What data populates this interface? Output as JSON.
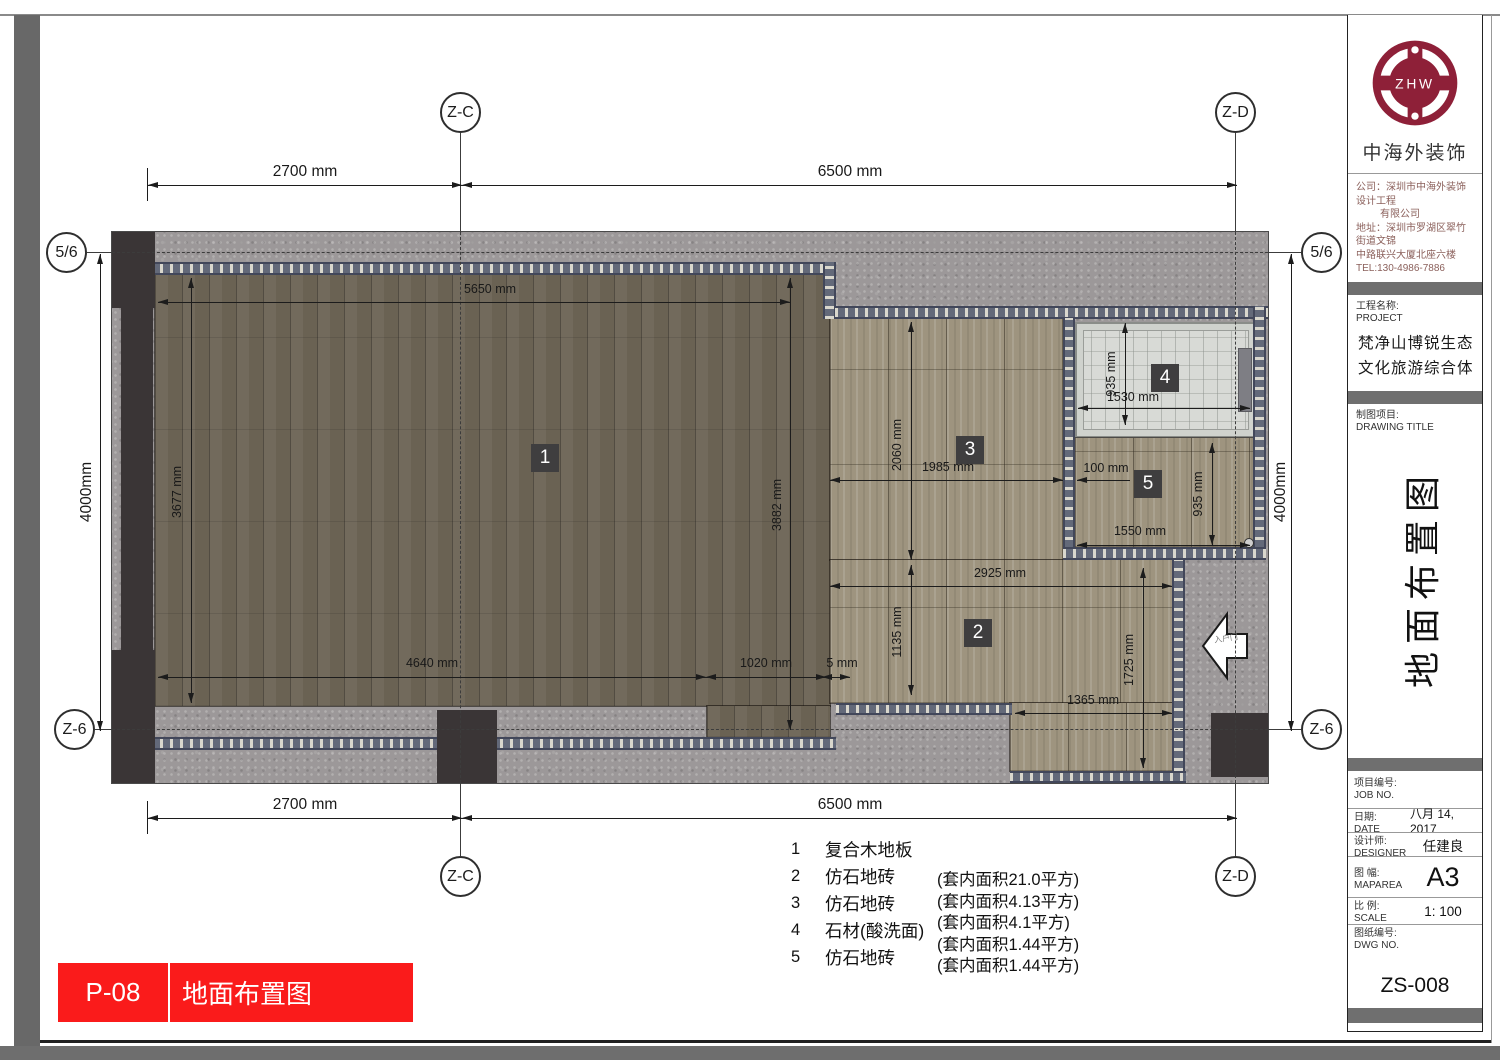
{
  "markers": {
    "zc": "Z-C",
    "zd": "Z-D",
    "axis56": "5/6",
    "z6": "Z-6"
  },
  "plan": {
    "entry_door": "入户门",
    "region_labels": {
      "r1": "1",
      "r2": "2",
      "r3": "3",
      "r4": "4",
      "r5": "5"
    },
    "dims": {
      "top_left": "2700 mm",
      "top_right": "6500 mm",
      "bottom_left": "2700 mm",
      "bottom_right": "6500 mm",
      "side_left": "4000mm",
      "side_right": "4000mm",
      "r1_top": "5650 mm",
      "r1_left": "3677 mm",
      "r1_bottom": "4640 mm",
      "r1_right": "3882 mm",
      "r1_notch": "1020 mm",
      "r1_gap": "5 mm",
      "r3_v": "2060 mm",
      "r3_h": "1985 mm",
      "r2_w": "2925 mm",
      "r2_v": "1135 mm",
      "r2_right_v": "1725 mm",
      "r2_bottom": "1365 mm",
      "r4_v": "935 mm",
      "r4_w": "1530 mm",
      "r5_off": "100 mm",
      "r5_v": "935 mm",
      "r5_w": "1550 mm"
    }
  },
  "legend": {
    "items": [
      {
        "no": "1",
        "name": "复合木地板",
        "area": "(套内面积21.0平方)"
      },
      {
        "no": "2",
        "name": "仿石地砖",
        "area": "(套内面积4.13平方)"
      },
      {
        "no": "3",
        "name": "仿石地砖",
        "area": "(套内面积4.1平方)"
      },
      {
        "no": "4",
        "name": "石材(酸洗面)",
        "area": "(套内面积1.44平方)"
      },
      {
        "no": "5",
        "name": "仿石地砖",
        "area": "(套内面积1.44平方)"
      }
    ]
  },
  "footer": {
    "sheet_no": "P-08",
    "sheet_title": "地面布置图"
  },
  "title_block": {
    "logo_text": "ZHW",
    "brand": "中海外装饰",
    "company_lines": [
      "公司：深圳市中海外装饰设计工程",
      "有限公司",
      "地址：深圳市罗湖区翠竹街道文锦",
      "中路联兴大厦北座六楼",
      "TEL:130-4986-7886"
    ],
    "project_label": "工程名称:",
    "project_label_en": "PROJECT",
    "project_name": "梵净山博锐生态文化旅游综合体",
    "drawing_label": "制图项目:",
    "drawing_label_en": "DRAWING TITLE",
    "drawing_title": "地面布置图",
    "job_label": "项目编号:",
    "job_label_en": "JOB NO.",
    "job_value": "",
    "date_label": "日期:",
    "date_label_en": "DATE",
    "date_value": "八月 14, 2017",
    "designer_label": "设计师:",
    "designer_label_en": "DESIGNER",
    "designer_value": "任建良",
    "size_label": "图 幅:",
    "size_label_en": "MAPAREA",
    "size_value": "A3",
    "scale_label": "比 例:",
    "scale_label_en": "SCALE",
    "scale_value": "1:  100",
    "dwg_label": "图纸编号:",
    "dwg_label_en": "DWG NO.",
    "dwg_value": "ZS-008"
  },
  "colors": {
    "accent_red": "#fa1b1b",
    "brand_maroon": "#8e2038",
    "mosaic_blue_gray": "#636979"
  }
}
